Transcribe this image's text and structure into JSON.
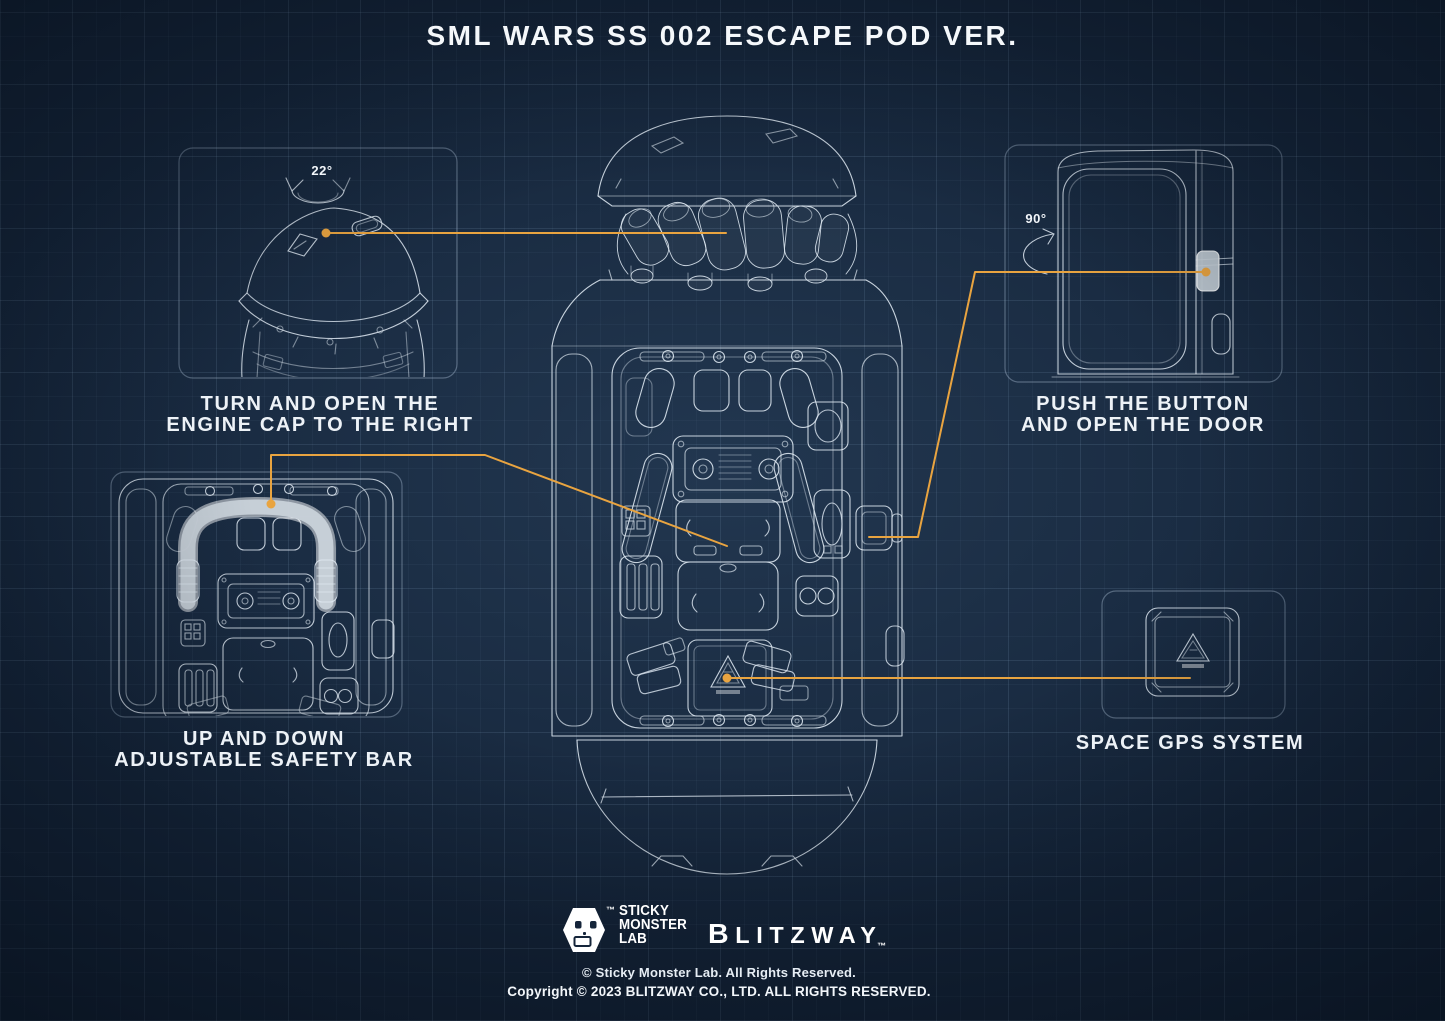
{
  "title": "SML WARS SS 002 ESCAPE POD VER.",
  "colors": {
    "accent_orange": "#E9A440",
    "blueprint_line": "#DFE9F2",
    "background_navy": "#15253A",
    "highlight_gray": "#C9D2DA"
  },
  "callouts": {
    "engine_cap": {
      "angle": "22°",
      "line1": "TURN AND OPEN THE",
      "line2": "ENGINE CAP TO THE RIGHT"
    },
    "door_button": {
      "angle": "90°",
      "line1": "PUSH THE BUTTON",
      "line2": "AND OPEN THE DOOR"
    },
    "safety_bar": {
      "line1": "UP AND DOWN",
      "line2": "ADJUSTABLE SAFETY BAR"
    },
    "gps": {
      "line1": "SPACE GPS SYSTEM"
    }
  },
  "footer": {
    "sml": {
      "tm": "™",
      "lines": [
        "STICKY",
        "MONSTER",
        "LAB"
      ]
    },
    "blitzway": {
      "wordmark": "BLITZWAY",
      "tm": "™"
    },
    "copyright_sml": "© Sticky Monster Lab. All Rights Reserved.",
    "copyright_blitzway": "Copyright © 2023 BLITZWAY CO., LTD. ALL RIGHTS RESERVED."
  }
}
